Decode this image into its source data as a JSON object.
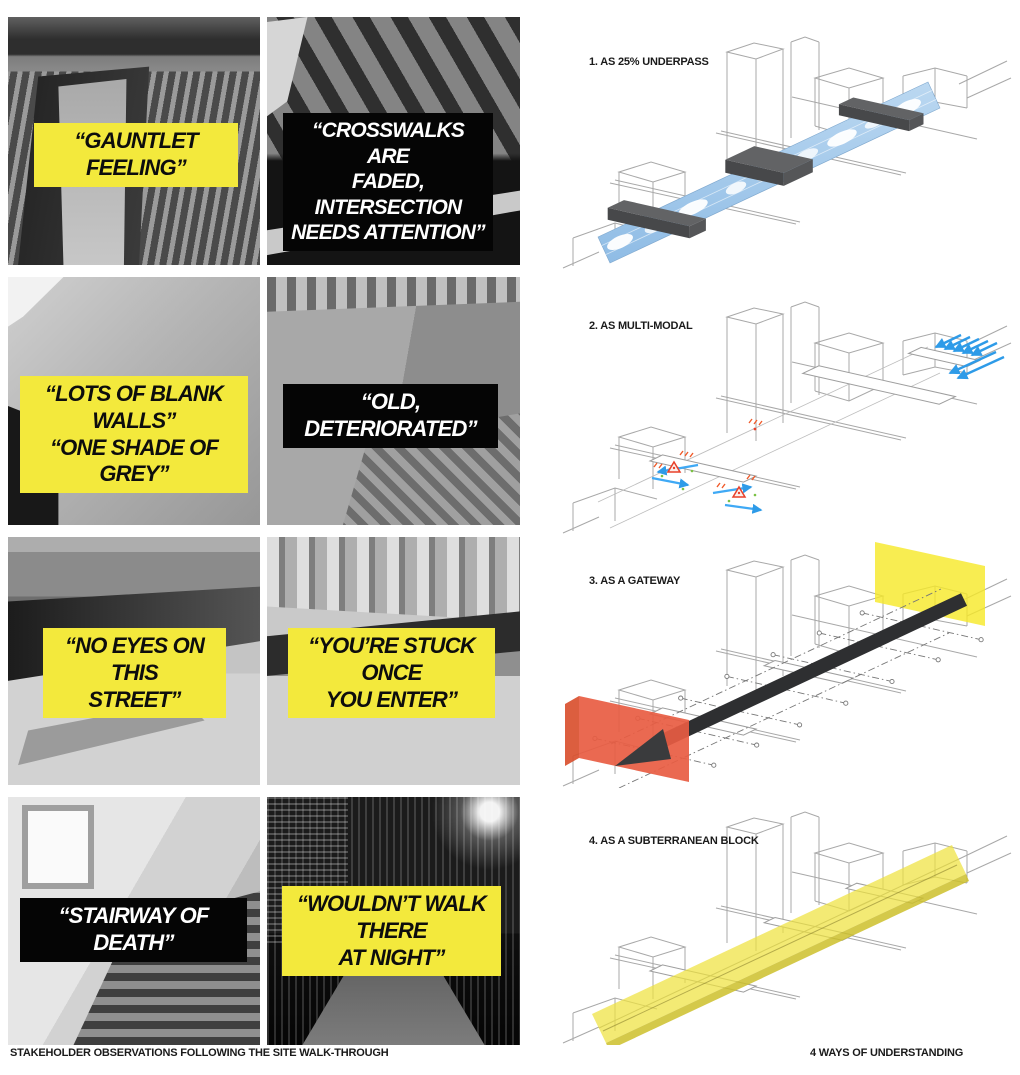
{
  "page": {
    "left_caption": "STAKEHOLDER OBSERVATIONS FOLLOWING THE SITE WALK-THROUGH",
    "right_caption": "4 WAYS OF UNDERSTANDING"
  },
  "quotes": [
    {
      "text": "“GAUNTLET FEELING”",
      "style": "yellow"
    },
    {
      "text": "“CROSSWALKS ARE\nFADED, INTERSECTION\nNEEDS ATTENTION”",
      "style": "black"
    },
    {
      "text": "“LOTS OF BLANK WALLS”\n“ONE SHADE OF GREY”",
      "style": "yellow"
    },
    {
      "text": "“OLD, DETERIORATED”",
      "style": "black"
    },
    {
      "text": "“NO EYES ON THIS\nSTREET”",
      "style": "yellow"
    },
    {
      "text": "“YOU’RE STUCK ONCE\nYOU ENTER”",
      "style": "yellow"
    },
    {
      "text": "“STAIRWAY OF DEATH”",
      "style": "black"
    },
    {
      "text": "“WOULDN’T WALK THERE\nAT NIGHT”",
      "style": "yellow"
    }
  ],
  "diagrams": [
    {
      "label": "1. AS 25% UNDERPASS"
    },
    {
      "label": "2. AS MULTI-MODAL"
    },
    {
      "label": "3. AS A GATEWAY"
    },
    {
      "label": "4. AS A SUBTERRANEAN BLOCK"
    }
  ],
  "colors": {
    "highlight_yellow": "#F3E93C",
    "label_black": "#050505",
    "sky_blue": "#A9CDEB",
    "arrow_blue": "#2E9BE8",
    "gateway_red": "#E85C42",
    "plane_yellow": "#F6E826",
    "block_grey": "#58595B",
    "wireframe_grey": "#A8A8A8"
  }
}
